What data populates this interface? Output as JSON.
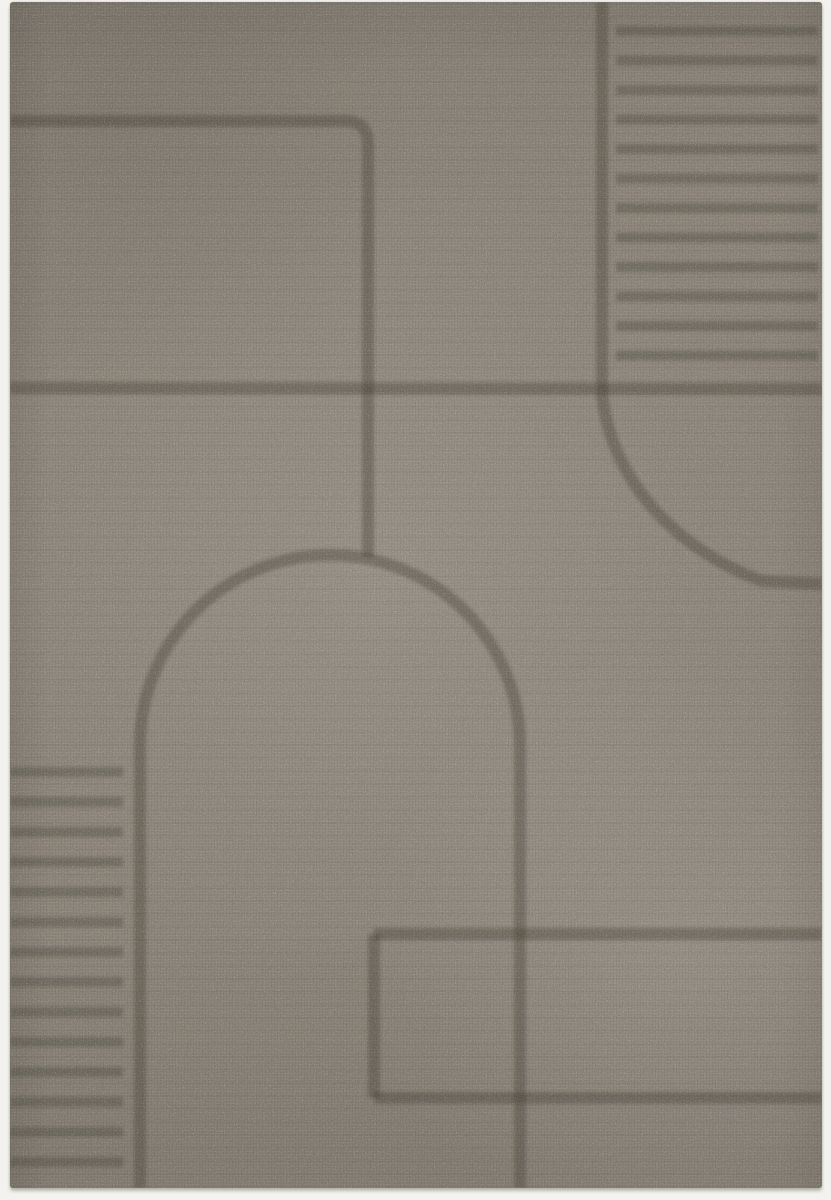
{
  "image": {
    "type": "product-photo",
    "subject": "Top-down photo of a rectangular grey-taupe short-pile area rug with a carved embossed geometric line pattern",
    "background_color": "#f3f2ee",
    "rug": {
      "base_color": "#8c8479",
      "line_color": "#3a342c",
      "texture": "speckled carpet grain with fine woven rows",
      "pattern_elements": [
        "rounded-corner line in the top-left",
        "vertical line with horizontal stripe block in the top-right",
        "full-width horizontal band across the middle",
        "quarter arc flowing into a horizontal tail at the middle-right",
        "large central arch whose legs run to the bottom edge",
        "horizontal stripe block in the bottom-left",
        "open rectangle lines in the bottom-right"
      ]
    }
  },
  "pattern": {
    "line_width": 12,
    "stripe_width": 10,
    "line_opacity": 0.34,
    "stripe_opacity": 0.3,
    "paths": [
      {
        "name": "topleft-rounded-corner-line",
        "d": "M 10 121 L 345 121 Q 368 121 368 144 L 368 557"
      },
      {
        "name": "right-vertical-quarter-arc-line",
        "d": "M 602 2 L 602 396 C 612 478 672 548 762 581 L 822 584"
      },
      {
        "name": "mid-horizontal-band",
        "d": "M 10 388 L 822 389"
      },
      {
        "name": "central-arch",
        "d": "M 140 1188 L 140 745 A 190 190 0 0 1 520 745 L 520 1188"
      },
      {
        "name": "bottomright-rect-top-line",
        "d": "M 374 934 L 822 934"
      },
      {
        "name": "bottomright-rect-left-line",
        "d": "M 374 934 L 374 1098"
      },
      {
        "name": "bottomright-rect-bottom-line",
        "d": "M 374 1098 L 822 1098"
      }
    ],
    "stripe_blocks": [
      {
        "name": "topright-stripes",
        "x1": 616,
        "x2": 818,
        "y_start": 31,
        "count": 12,
        "step": 29.5
      },
      {
        "name": "bottomleft-stripes",
        "x1": 10,
        "x2": 123,
        "y_start": 772,
        "count": 14,
        "step": 30
      }
    ]
  }
}
